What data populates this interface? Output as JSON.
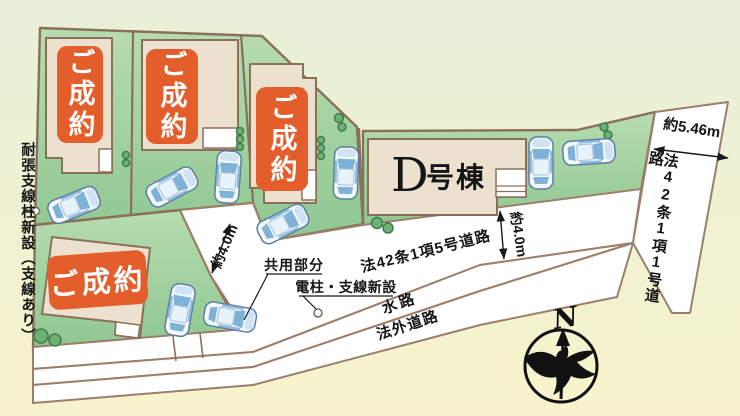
{
  "plan": {
    "badges": {
      "sold": "ご成約"
    },
    "buildings": {
      "d_letter": "D",
      "d_suffix": "号棟"
    },
    "roads": {
      "r5": "法42条1項5号道路",
      "r1": "法42条1項1号道路",
      "waterway": "水路",
      "outside": "法外道路",
      "shared": "共用部分"
    },
    "notes": {
      "pole_new": "電柱・支線新設",
      "left_note": "耐張支線柱新設（支線あり）"
    },
    "dims": {
      "w546": "約5.46m",
      "w40_road": "約4.0m",
      "w40_drive": "約4.0m"
    },
    "compass": {
      "north": "N"
    },
    "colors": {
      "sold_badge": "#e45e2c",
      "site_green": "#9ccf9e",
      "boundary_brown": "#8a7058",
      "road_white": "#ffffff"
    }
  }
}
